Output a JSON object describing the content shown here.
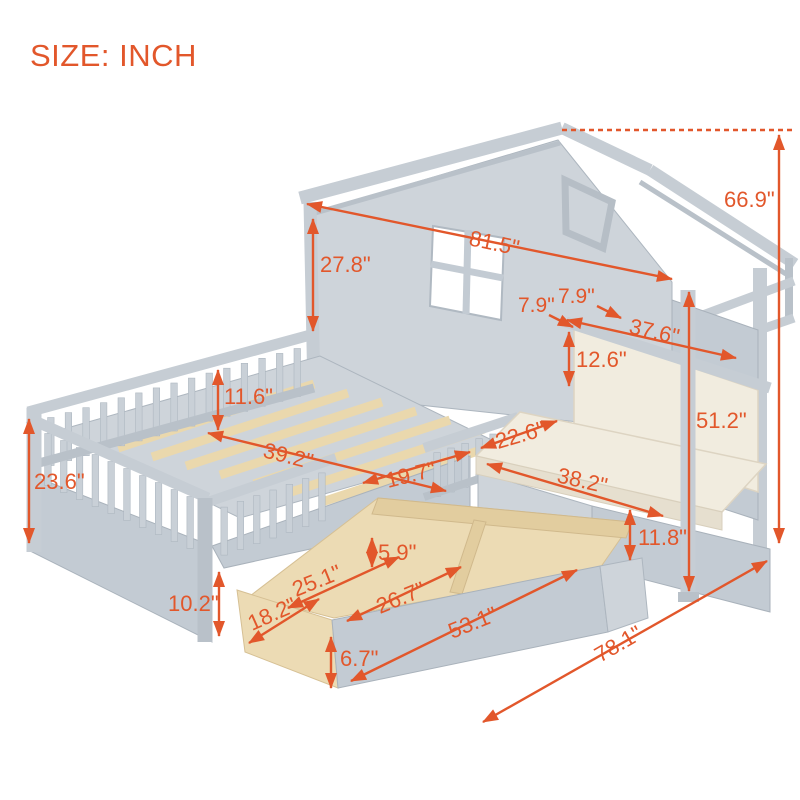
{
  "header": {
    "size_label": "SIZE: INCH"
  },
  "colors": {
    "accent": "#e2572b",
    "frame_gray": "#c6cdd4",
    "frame_shadow": "#b9c1c9",
    "cushion_cream": "#f1ecdf",
    "wood_natural": "#ecdbb4"
  },
  "dims": {
    "overall_height": "66.9\"",
    "bed_length": "81.5\"",
    "gable_height": "27.8\"",
    "shelf_depth_a": "7.9\"",
    "shelf_depth_b": "7.9\"",
    "backrest_width": "37.6\"",
    "backrest_height": "12.6\"",
    "rail_height": "11.6\"",
    "side_height": "23.6\"",
    "bed_width": "39.2\"",
    "entry_width": "19.7\"",
    "bench_depth": "22.6\"",
    "bench_width": "38.2\"",
    "bench_height": "51.2\"",
    "bench_base_height": "11.8\"",
    "drawer_inner_height": "5.9\"",
    "drawer_section_length": "25.1\"",
    "clearance_height": "10.2\"",
    "drawer_depth": "18.2\"",
    "drawer_section2_length": "26.7\"",
    "drawer_total_length": "53.1\"",
    "drawer_front_height": "6.7\"",
    "overall_depth": "78.1\""
  }
}
